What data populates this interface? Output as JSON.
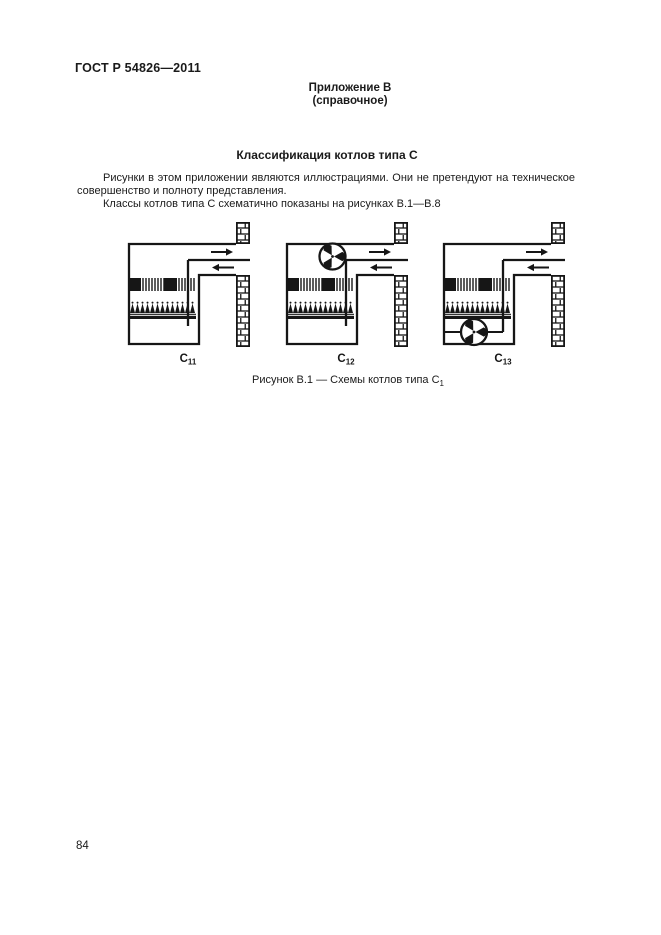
{
  "page": {
    "doc_number": "ГОСТ Р 54826—2011",
    "appendix_label": "Приложение В",
    "appendix_type": "(справочное)",
    "title": "Классификация котлов типа С",
    "paragraph1": "Рисунки в этом приложении являются иллюстрациями. Они не претендуют на техническое совершенство и полноту представления.",
    "paragraph2": "Классы котлов типа С схематично показаны на рисунках В.1—В.8",
    "caption_text": "Рисунок В.1 — Схемы котлов типа С",
    "caption_sub": "1",
    "page_number": "84"
  },
  "diagrams": [
    {
      "label_base": "С",
      "label_sub": "11",
      "fan": "none",
      "parts": [
        "boiler-casing",
        "flue-outlet-duct",
        "air-inlet-duct",
        "heat-exchanger",
        "burner",
        "wall-bricks"
      ]
    },
    {
      "label_base": "С",
      "label_sub": "12",
      "fan": "top",
      "parts": [
        "boiler-casing",
        "flue-outlet-duct",
        "air-inlet-duct",
        "heat-exchanger",
        "burner",
        "wall-bricks",
        "fan"
      ]
    },
    {
      "label_base": "С",
      "label_sub": "13",
      "fan": "bottom",
      "parts": [
        "boiler-casing",
        "flue-outlet-duct",
        "air-inlet-duct",
        "heat-exchanger",
        "burner",
        "wall-bricks",
        "fan"
      ]
    }
  ],
  "colors": {
    "ink": "#161616",
    "paper": "#ffffff"
  }
}
